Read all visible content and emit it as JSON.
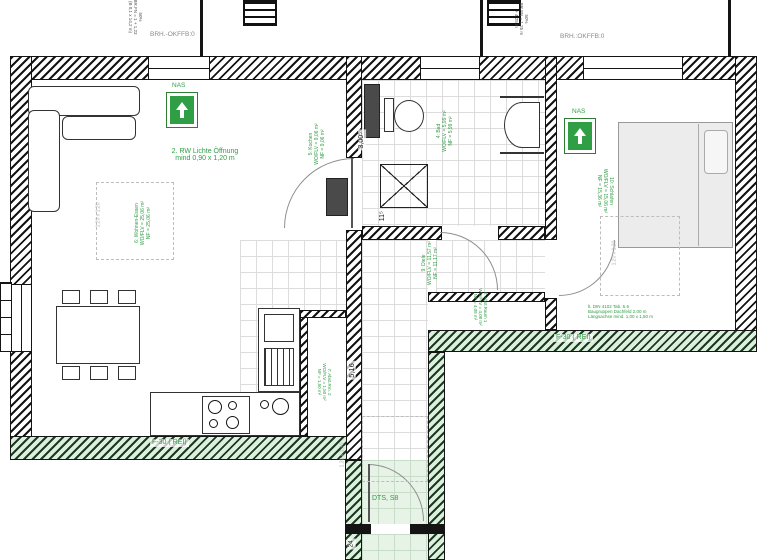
{
  "colors": {
    "accent_green": "#2f9e44",
    "wall_black": "#141414",
    "fire_wall_bg": "#ddefdd",
    "entry_bg": "#e7f3e7",
    "dash_gray": "#bdbdbd"
  },
  "top": {
    "brh_left": "BRH.-OKFFB:0",
    "brh_right": "BRH.:OKFFB:0",
    "note_left": {
      "l1": "50%",
      "l2": "BR.FN = 1 + 1,23",
      "l3": "(B 0,1 x 14,2 m)"
    },
    "note_right": {
      "l1": "50%",
      "l2": "BR.FN = 1,25 m",
      "l3": "+ 4,25 m"
    }
  },
  "rooms": {
    "wohnen": {
      "l1": "6: Wohnen-Essen",
      "l2": "WO/FLV = 25,06 m²",
      "l3": "NF  = 25,06 m²"
    },
    "kochen": {
      "l1": "5: Kochen",
      "l2": "WO/FLV = 9,06 m²",
      "l3": "NF  = 9,06 m²"
    },
    "bad": {
      "l1": "4: Bad",
      "l2": "WO/FLV = 5,99 m²",
      "l3": "NF  = 5,99 m²"
    },
    "diele": {
      "l1": "9: Diele",
      "l2": "WO/FLV = 11,57 m²",
      "l3": "NF  = 11,17 m²"
    },
    "schlafen": {
      "l1": "10: Schlafen",
      "l2": "WO/FLV = 15,06 m²",
      "l3": "NF  = 15,36 m²"
    },
    "abst1": {
      "l1": "8: Abst.Raum 1",
      "l2": "WO/FLV = 4,08 m²",
      "l3": "NF  = 4,08 m²"
    },
    "abst2": {
      "l1": "7: Abst.Rm. 2",
      "l2": "WO/FLV = 1,50 m²",
      "l3": "NF  = 1,50 m²"
    }
  },
  "notes": {
    "rw1": "2. RW Lichte Öffnung",
    "rw2": "mind 0,90 x 1,20 m",
    "nas": "NAS",
    "f30": "F-30 ( REI)",
    "dts": "DTS, S8",
    "fire1": "lt. DIN 4102 Tab. 5.6",
    "fire2": "Baugruppen Dachfeld 2,00 m",
    "fire3": "Längsachse mind. 1,00 x 1,50 m"
  },
  "dims": {
    "w_bath": "3,00⁵",
    "w_corr": "11⁵",
    "h_corr": "5,16",
    "h_entry": "24",
    "sq_a": "1,20 x 1,20",
    "sq_b": "1,20 x 1,20",
    "sq_c": "1,30 x 1,30"
  }
}
